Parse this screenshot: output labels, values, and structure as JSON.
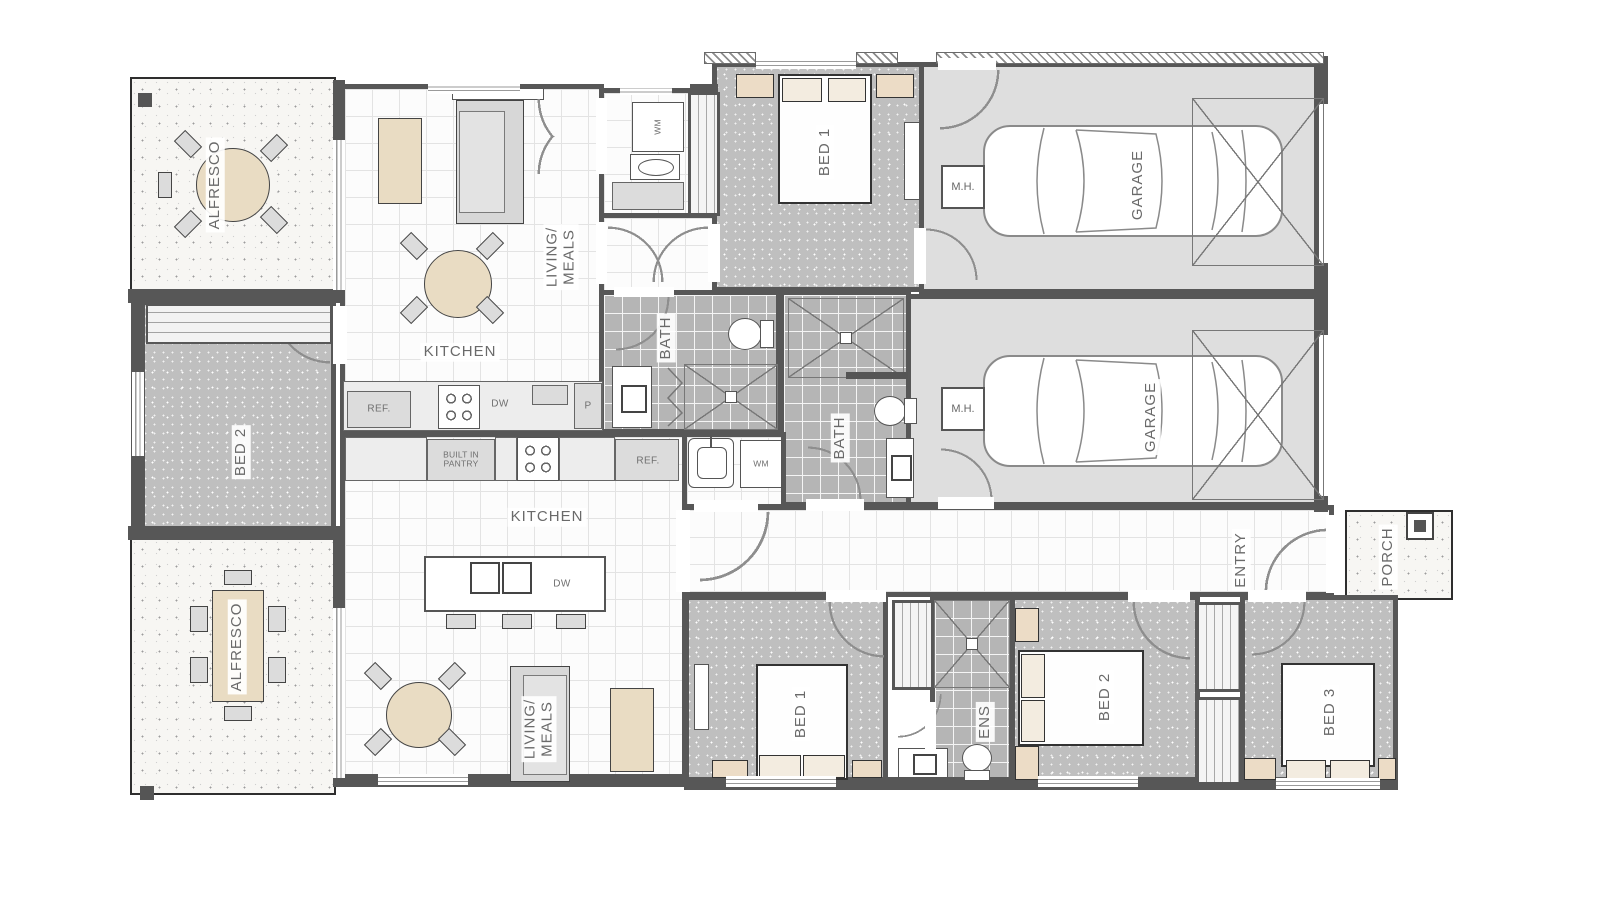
{
  "plan_type": "dual-occupancy-floor-plan",
  "colors": {
    "wall": "#575757",
    "carpet": "#bfbfbf",
    "tile_white": "#fcfcfc",
    "tile_bath": "#b5b5b5",
    "garage_floor": "#dedede",
    "timber": "#e9dcc3",
    "bedside": "#ecdcc6"
  },
  "labels": {
    "d1": {
      "alfresco": "ALFRESCO",
      "living": "LIVING/\nMEALS",
      "kitchen": "KITCHEN",
      "bath": "BATH",
      "bed1": "BED 1",
      "bed2": "BED 2",
      "garage": "GARAGE",
      "mh": "M.H.",
      "wm": "WM",
      "ref": "REF.",
      "dw": "DW",
      "pantry": "P"
    },
    "d2": {
      "alfresco": "ALFRESCO",
      "builtin": "BUILT IN\nPANTRY",
      "kitchen": "KITCHEN",
      "ref": "REF.",
      "wm": "WM",
      "dw": "DW",
      "living": "LIVING/\nMEALS",
      "bath": "BATH",
      "ens": "ENS",
      "bed1": "BED 1",
      "bed2": "BED 2",
      "bed3": "BED 3",
      "garage": "GARAGE",
      "mh": "M.H.",
      "entry": "ENTRY",
      "porch": "PORCH"
    }
  }
}
